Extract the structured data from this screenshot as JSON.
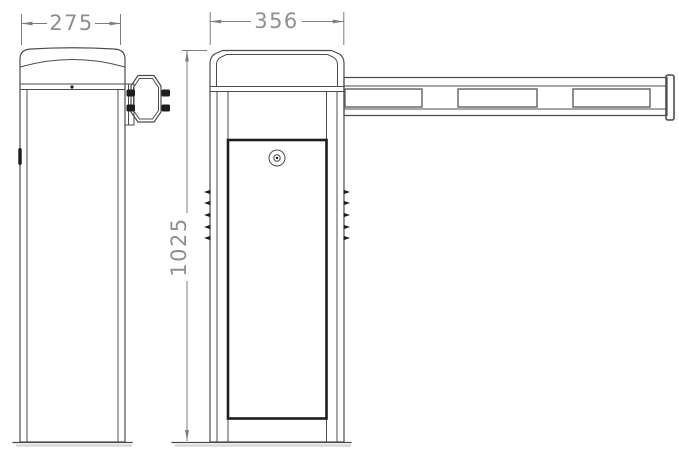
{
  "dimensions": {
    "side_width": "275",
    "front_width": "356",
    "height": "1025"
  },
  "parts": {
    "side_view": "barrier-gate-cabinet-side-view",
    "front_view": "barrier-gate-cabinet-front-view",
    "boom": "boom-arm",
    "boom_panel_count": 3,
    "bracket": "boom-mount-bracket",
    "keyhole": "door-lock-keyhole",
    "door": "cabinet-door-panel",
    "vents": "side-louver-vents"
  },
  "colors": {
    "line": "#4c4c4c",
    "heavy_line": "#1d1d1d",
    "panel_line": "#606060",
    "dim_line": "#7d7d7d",
    "dim_text": "#8f8f8f",
    "shadow": "#d2d2d2",
    "background": "#ffffff"
  }
}
